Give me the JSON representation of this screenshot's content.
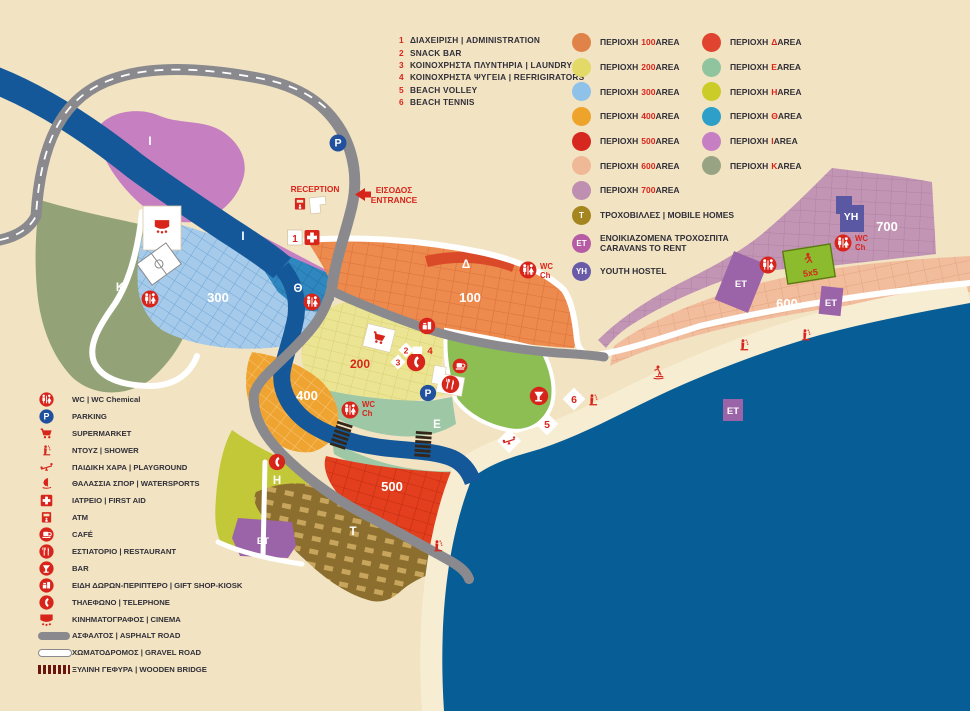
{
  "colors": {
    "background": "#F2E4C3",
    "sea": "#075D95",
    "river": "#14589A",
    "road": "#8A8A8E",
    "beach": "#F7EDD2",
    "icon_red": "#D8251C",
    "parking_blue": "#20509E",
    "text_dark": "#312F38",
    "area_100": "#ED8A4E",
    "area_200": "#EBE493",
    "area_300": "#A6CAEA",
    "area_400": "#EFA432",
    "area_500": "#E33E1E",
    "area_600": "#F2BD9D",
    "area_700": "#C295B5",
    "area_delta": "#DA4A28",
    "area_epsilon": "#9EC7A5",
    "area_eta": "#C2C838",
    "area_theta": "#2E87BE",
    "area_iota": "#C67FC0",
    "area_kappa": "#93A377",
    "mobile_homes": "#8C6F2E",
    "caravans": "#9C64A8",
    "youth_hostel": "#5A58A2",
    "pitch_green": "#8CBB2D"
  },
  "words": {
    "periochi": "ΠΕΡΙΟΧΗ",
    "area": "AREA"
  },
  "facilities": {
    "items": [
      {
        "num": "1",
        "label": "ΔΙΑΧΕΙΡΙΣΗ | ADMINISTRATION"
      },
      {
        "num": "2",
        "label": "SNACK BAR"
      },
      {
        "num": "3",
        "label": "ΚΟΙΝΟΧΡΗΣΤΑ ΠΛΥΝΤΗΡΙΑ | LAUNDRY"
      },
      {
        "num": "4",
        "label": "ΚΟΙΝΟΧΡΗΣΤΑ ΨΥΓΕΙΑ | REFRIGIRATORS"
      },
      {
        "num": "5",
        "label": "BEACH VOLLEY"
      },
      {
        "num": "6",
        "label": "BEACH TENNIS"
      }
    ]
  },
  "areas_numeric": {
    "items": [
      {
        "code": "100"
      },
      {
        "code": "200"
      },
      {
        "code": "300"
      },
      {
        "code": "400"
      },
      {
        "code": "500"
      },
      {
        "code": "600"
      },
      {
        "code": "700"
      }
    ]
  },
  "areas_letters": {
    "items": [
      {
        "code": "Δ"
      },
      {
        "code": "Ε"
      },
      {
        "code": "Η"
      },
      {
        "code": "Θ"
      },
      {
        "code": "Ι"
      },
      {
        "code": "Κ"
      }
    ]
  },
  "special": {
    "items": [
      {
        "badge": "T",
        "label": "ΤΡΟΧΟΒΙΛΛΕΣ | MOBILE HOMES",
        "label2": ""
      },
      {
        "badge": "ET",
        "label": "ΕΝΟΙΚΙΑΖΟΜΕΝΑ ΤΡΟΧΟΣΠΙΤΑ",
        "label2": "CARAVANS TO RENT"
      },
      {
        "badge": "YH",
        "label": "YOUTH HOSTEL",
        "label2": ""
      }
    ]
  },
  "icon_legend": {
    "items": [
      {
        "label": "WC | WC Chemical"
      },
      {
        "label": "PARKING"
      },
      {
        "label": "SUPERMARKET"
      },
      {
        "label": "ΝΤΟΥΖ | SHOWER"
      },
      {
        "label": "ΠΑΙΔΙΚΗ ΧΑΡΑ | PLAYGROUND"
      },
      {
        "label": "ΘΑΛΑΣΣΙΑ ΣΠΟΡ | WATERSPORTS"
      },
      {
        "label": "ΙΑΤΡΕΙΟ | FIRST AID"
      },
      {
        "label": "ATM"
      },
      {
        "label": "CAFÉ"
      },
      {
        "label": "ΕΣΤΙΑΤΟΡΙΟ | RESTAURANT"
      },
      {
        "label": "BAR"
      },
      {
        "label": "ΕΙΔΗ ΔΩΡΩΝ-ΠΕΡΙΠΤΕΡΟ | GIFT SHOP-KIOSK"
      },
      {
        "label": "ΤΗΛΕΦΩΝΟ | TELEPHONE"
      },
      {
        "label": "ΚΙΝΗΜΑΤΟΓΡΑΦΟΣ | CINEMA"
      },
      {
        "label": "ΑΣΦΑΛΤΟΣ | ASPHALT ROAD"
      },
      {
        "label": "ΧΩΜΑΤΟΔΡΟΜΟΣ | GRAVEL ROAD"
      },
      {
        "label": "ΞΥΛΙΝΗ ΓΕΦΥΡΑ | WOODEN BRIDGE"
      }
    ]
  },
  "map": {
    "reception": "RECEPTION",
    "entrance_gr": "ΕΙΣΟΔΟΣ",
    "entrance_en": "ENTRANCE",
    "wc": "WC",
    "ch": "Ch",
    "parking": "P",
    "areas": {
      "a100": "100",
      "a200": "200",
      "a300": "300",
      "a400": "400",
      "a500": "500",
      "a600": "600",
      "a700": "700",
      "delta": "Δ",
      "epsilon": "E",
      "eta": "H",
      "theta": "Θ",
      "iota": "I",
      "kappa": "K",
      "tau": "T",
      "et": "ET",
      "yh": "YH",
      "pitch": "5x5"
    },
    "markers": {
      "m1": "1",
      "m2": "2",
      "m3": "3",
      "m4": "4",
      "m5": "5",
      "m6": "6"
    }
  }
}
